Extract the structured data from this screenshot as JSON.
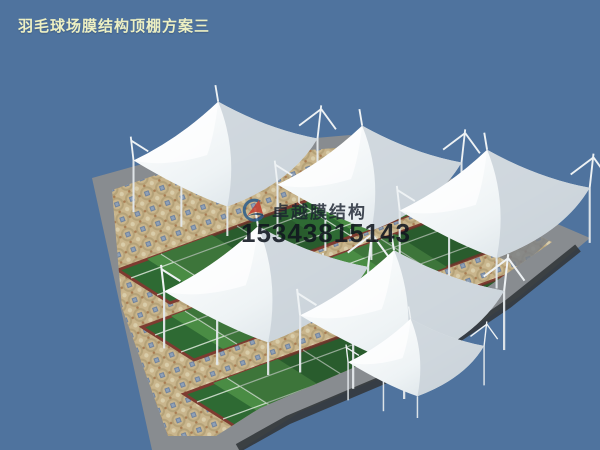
{
  "title": {
    "text": "羽毛球场膜结构顶棚方案三"
  },
  "watermark": {
    "company": "卓越膜结构",
    "phone": "15343815143",
    "logo_icon": "swoosh-globe-logo"
  },
  "scene": {
    "canopy_count": 6,
    "court_strip_count": 3,
    "colors": {
      "sky": "#4f739e",
      "canopy_white": "#f6f9fa",
      "canopy_shade": "#ccd5dc",
      "court_green_dark": "#2e6a33",
      "court_green_light": "#4a8c44",
      "court_line": "#dde8dc",
      "court_edging": "#7e3b30",
      "paver_tan": "#c9b58c",
      "paver_blue": "#71849e",
      "apron_gray": "#888c90",
      "apron_dark": "#33373b",
      "title_text": "#edf0c3",
      "watermark_text": "#1b2330",
      "logo_blue": "#2b5e8c",
      "logo_red": "#c23b2e"
    }
  }
}
